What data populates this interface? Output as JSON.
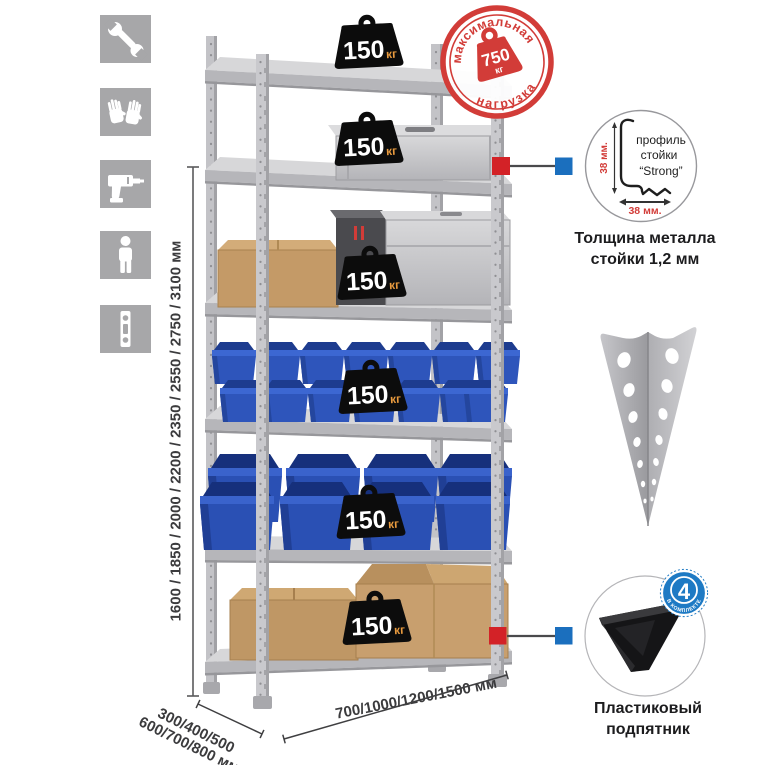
{
  "colors": {
    "accent_red": "#d23c38",
    "marker_red": "#d32227",
    "marker_blue": "#1b6fbe",
    "badge_black": "#0c0c0c",
    "badge_unit_orange": "#e89a3e",
    "bin_blue": "#2e55bb",
    "cardboard": "#c49a67",
    "metal_gray": "#c3c3c7",
    "icon_gray": "#a7a7a9"
  },
  "sidebar": {
    "icons": [
      {
        "name": "wrench-icon"
      },
      {
        "name": "gloves-icon"
      },
      {
        "name": "drill-icon"
      },
      {
        "name": "person-icon"
      },
      {
        "name": "level-icon"
      }
    ]
  },
  "dimensions": {
    "height": "1600 / 1850 / 2000 / 2200 / 2350 / 2550 / 2750 / 3100 мм",
    "depth_line1": "300/400/500",
    "depth_line2": "600/700/800 мм",
    "width": "700/1000/1200/1500 мм"
  },
  "shelving": {
    "shelf_loads": [
      {
        "value": "150",
        "unit": "кг"
      },
      {
        "value": "150",
        "unit": "кг"
      },
      {
        "value": "150",
        "unit": "кг"
      },
      {
        "value": "150",
        "unit": "кг"
      },
      {
        "value": "150",
        "unit": "кг"
      },
      {
        "value": "150",
        "unit": "кг"
      }
    ]
  },
  "stamp": {
    "arc_top": "максимальная",
    "arc_bottom": "нагрузка",
    "value": "750",
    "unit": "кг"
  },
  "profile_detail": {
    "label_line1": "профиль",
    "label_line2": "стойки",
    "label_line3": "“Strong”",
    "dim_vertical": "38 мм.",
    "dim_horizontal": "38 мм.",
    "caption_line1": "Толщина металла",
    "caption_line2": "стойки 1,2 мм"
  },
  "foot_detail": {
    "badge_value": "4",
    "badge_arc": "В КОМПЛЕКТЕ",
    "caption_line1": "Пластиковый",
    "caption_line2": "подпятник"
  }
}
